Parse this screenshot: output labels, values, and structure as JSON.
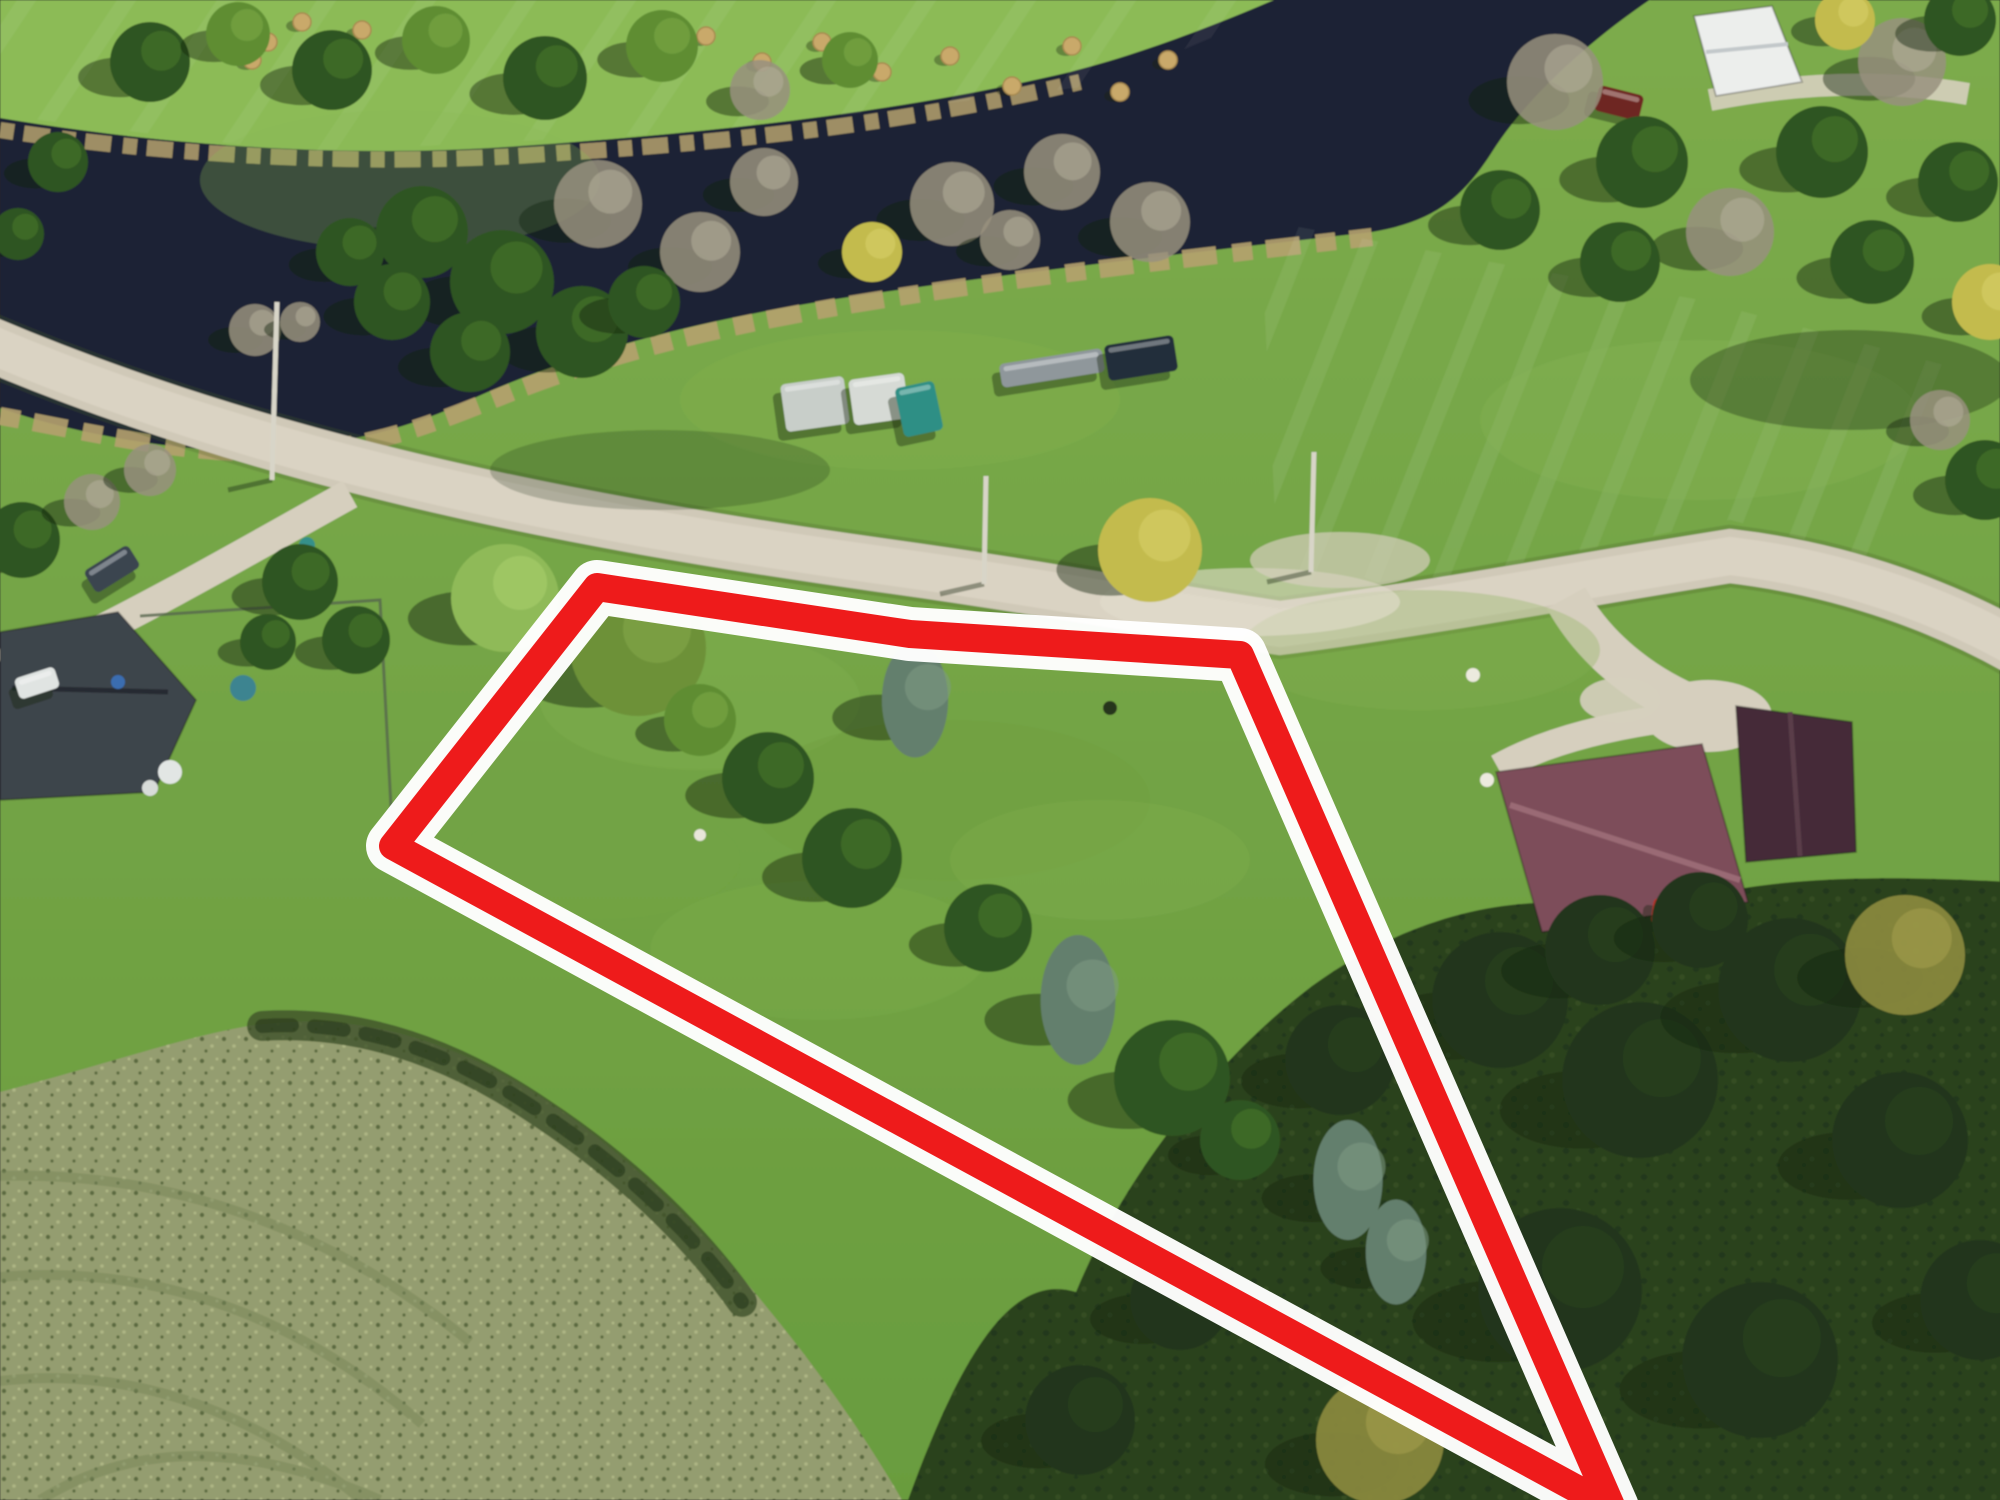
{
  "meta": {
    "domain": "aerial-real-estate-photo",
    "description": "Drone aerial photo of a vacant rural land parcel outlined with a red/white boundary overlay; road to the north, dark river beyond, neighboring houses east and west, tilled field to the southwest.",
    "visible_text": []
  },
  "annotation": {
    "outline_color": "#ee1b1b",
    "halo_color": "#ffffff",
    "outline_width": 28,
    "halo_width": 54
  },
  "scene": {
    "palette": {
      "grass_top": "#7cab4b",
      "grass_bottom": "#699c3e",
      "north_lawn": "#8cbb57",
      "water": "#1c2334",
      "reeds": "#b5a16e",
      "road": "#d0c9b8",
      "road_light": "#e1dbcc",
      "road_shoulder": "rgba(70,90,40,0.25)",
      "driveway": "#d6cfbe",
      "field": "#949d6f",
      "field_dot_dark": "#5b6b41",
      "field_dot_light": "#adb584",
      "scrub": "#3f5229",
      "canopy": "#2c421f",
      "canopy_dot": "#1f3316",
      "fence": "#55654c",
      "peninsula": "#83b351"
    },
    "paths": {
      "north_lawn": "M 0,0 L 1340,0 C 1266,32 1180,60 1078,80 C 900,116 700,140 520,150 C 360,160 180,150 0,122 Z",
      "river": "M 0,118 C 180,148 360,158 520,146 C 720,132 900,112 1070,72 C 1164,48 1256,8 1320,-20 L 1680,-20 C 1600,30 1530,92 1492,152 C 1460,202 1430,222 1372,232 C 1180,254 1000,274 830,300 C 680,324 566,356 470,400 C 386,440 280,458 180,447 C 100,438 40,422 0,408 Z",
      "reed_north": "M 0,130 C 200,160 400,166 560,153 C 760,140 920,120 1080,82",
      "reed_south": "M 0,416 C 80,430 160,450 252,453 C 362,453 422,428 502,396 C 602,356 702,330 842,306 C 1002,279 1182,259 1372,237",
      "peninsula": "M 165,352 C 184,312 240,292 300,300 C 346,308 356,330 330,353 C 290,379 205,383 165,352 Z",
      "field": "M 0,1092 C 120,1060 200,1032 262,1024 C 340,1016 400,1028 470,1058 C 560,1098 640,1168 716,1248 C 790,1330 856,1420 902,1500 L 0,1500 Z",
      "scrub": "M 262,1026 C 360,1020 452,1052 540,1112 C 622,1166 692,1232 742,1302",
      "canopy": "M 908,1500 C 962,1352 1012,1272 1076,1292 C 1122,1180 1212,1062 1312,986 C 1422,906 1542,886 1642,916 C 1722,882 1832,872 2010,882 L 2010,1510 L 908,1510 Z",
      "road": "M -20,340 C 260,460 560,520 880,565 C 1060,590 1170,612 1280,628 C 1420,610 1580,580 1730,556 C 1850,570 1950,610 2020,650",
      "drive_west": "M 350,494 C 256,546 160,602 60,650",
      "drive_east": "M 1566,598 C 1596,652 1648,692 1710,714",
      "drive_east_spur": "M 1706,714 C 1620,722 1548,740 1498,768",
      "drive_ne": "M 1710,100 C 1790,84 1878,78 1968,94",
      "arc1": "M -60,1180 C 140,1158 320,1220 470,1342",
      "arc2": "M -60,1285 C 120,1252 282,1302 422,1424",
      "arc3": "M -60,1392 C 100,1352 242,1402 362,1500",
      "arc4": "M 40,1500 C 150,1432 270,1452 380,1500"
    },
    "parcel": {
      "points": "597,587 910,634 1240,655 1612,1508 393,846"
    },
    "fence_points": "140,616 380,600 393,845",
    "tree_styles": {
      "conifer": {
        "fill": "#2f5520",
        "hl": "#477a2c",
        "op": 1
      },
      "deciduous": {
        "fill": "#5f8d33",
        "hl": "#7cab47",
        "op": 1
      },
      "deciduous-light": {
        "fill": "#8fba58",
        "hl": "#abd06f",
        "op": 1
      },
      "olive": {
        "fill": "#6d9139",
        "hl": "#85a94d",
        "op": 1
      },
      "bare": {
        "fill": "#98917e",
        "hl": "#b5ae9b",
        "op": 0.85
      },
      "spruce": {
        "fill": "#647f6d",
        "hl": "#7e9a84",
        "op": 1
      },
      "yellow": {
        "fill": "#c3bb4e",
        "hl": "#d8d169",
        "op": 1
      },
      "dark": {
        "fill": "#20351a",
        "hl": "#2c4620",
        "op": 1
      },
      "yellow-dark": {
        "fill": "#8d8c3e",
        "hl": "#a5a14d",
        "op": 0.9
      }
    },
    "trees": [
      {
        "x": 150,
        "y": 62,
        "r": 40,
        "type": "conifer"
      },
      {
        "x": 238,
        "y": 34,
        "r": 32,
        "type": "deciduous"
      },
      {
        "x": 332,
        "y": 70,
        "r": 40,
        "type": "conifer"
      },
      {
        "x": 436,
        "y": 40,
        "r": 34,
        "type": "deciduous"
      },
      {
        "x": 545,
        "y": 78,
        "r": 42,
        "type": "conifer"
      },
      {
        "x": 662,
        "y": 46,
        "r": 36,
        "type": "deciduous"
      },
      {
        "x": 58,
        "y": 162,
        "r": 30,
        "type": "conifer"
      },
      {
        "x": 18,
        "y": 234,
        "r": 26,
        "type": "conifer"
      },
      {
        "x": 760,
        "y": 90,
        "r": 30,
        "type": "bare"
      },
      {
        "x": 850,
        "y": 60,
        "r": 28,
        "type": "deciduous"
      },
      {
        "x": 598,
        "y": 204,
        "r": 44,
        "type": "bare"
      },
      {
        "x": 700,
        "y": 252,
        "r": 40,
        "type": "bare"
      },
      {
        "x": 764,
        "y": 182,
        "r": 34,
        "type": "bare"
      },
      {
        "x": 952,
        "y": 204,
        "r": 42,
        "type": "bare"
      },
      {
        "x": 1062,
        "y": 172,
        "r": 38,
        "type": "bare"
      },
      {
        "x": 1150,
        "y": 222,
        "r": 40,
        "type": "bare"
      },
      {
        "x": 872,
        "y": 252,
        "r": 30,
        "type": "yellow"
      },
      {
        "x": 1010,
        "y": 240,
        "r": 30,
        "type": "bare"
      },
      {
        "x": 422,
        "y": 232,
        "r": 46,
        "type": "conifer"
      },
      {
        "x": 502,
        "y": 282,
        "r": 52,
        "type": "conifer"
      },
      {
        "x": 582,
        "y": 332,
        "r": 46,
        "type": "conifer"
      },
      {
        "x": 470,
        "y": 352,
        "r": 40,
        "type": "conifer"
      },
      {
        "x": 392,
        "y": 302,
        "r": 38,
        "type": "conifer"
      },
      {
        "x": 644,
        "y": 302,
        "r": 36,
        "type": "conifer"
      },
      {
        "x": 350,
        "y": 252,
        "r": 34,
        "type": "conifer"
      },
      {
        "x": 255,
        "y": 330,
        "r": 26,
        "type": "bare"
      },
      {
        "x": 300,
        "y": 322,
        "r": 20,
        "type": "bare"
      },
      {
        "x": 1555,
        "y": 82,
        "r": 48,
        "type": "bare"
      },
      {
        "x": 1642,
        "y": 162,
        "r": 46,
        "type": "conifer"
      },
      {
        "x": 1500,
        "y": 210,
        "r": 40,
        "type": "conifer"
      },
      {
        "x": 1730,
        "y": 232,
        "r": 44,
        "type": "bare"
      },
      {
        "x": 1822,
        "y": 152,
        "r": 46,
        "type": "conifer"
      },
      {
        "x": 1902,
        "y": 62,
        "r": 44,
        "type": "bare"
      },
      {
        "x": 1958,
        "y": 182,
        "r": 40,
        "type": "conifer"
      },
      {
        "x": 1872,
        "y": 262,
        "r": 42,
        "type": "conifer"
      },
      {
        "x": 1990,
        "y": 302,
        "r": 38,
        "type": "yellow"
      },
      {
        "x": 1620,
        "y": 262,
        "r": 40,
        "type": "conifer"
      },
      {
        "x": 1960,
        "y": 20,
        "r": 36,
        "type": "conifer"
      },
      {
        "x": 1845,
        "y": 20,
        "r": 30,
        "type": "yellow"
      },
      {
        "x": 1985,
        "y": 480,
        "r": 40,
        "type": "conifer"
      },
      {
        "x": 1940,
        "y": 420,
        "r": 30,
        "type": "bare"
      },
      {
        "x": 505,
        "y": 598,
        "r": 54,
        "type": "deciduous-light"
      },
      {
        "x": 638,
        "y": 648,
        "r": 68,
        "type": "olive"
      },
      {
        "x": 700,
        "y": 720,
        "r": 36,
        "type": "deciduous"
      },
      {
        "x": 768,
        "y": 778,
        "r": 46,
        "type": "conifer"
      },
      {
        "x": 852,
        "y": 858,
        "r": 50,
        "type": "conifer"
      },
      {
        "x": 915,
        "y": 700,
        "r": 46,
        "type": "spruce"
      },
      {
        "x": 988,
        "y": 928,
        "r": 44,
        "type": "conifer"
      },
      {
        "x": 1078,
        "y": 1000,
        "r": 52,
        "type": "spruce"
      },
      {
        "x": 1172,
        "y": 1078,
        "r": 58,
        "type": "conifer"
      },
      {
        "x": 1240,
        "y": 1140,
        "r": 40,
        "type": "conifer"
      },
      {
        "x": 1348,
        "y": 1180,
        "r": 48,
        "type": "spruce"
      },
      {
        "x": 1396,
        "y": 1252,
        "r": 42,
        "type": "spruce"
      },
      {
        "x": 1150,
        "y": 550,
        "r": 52,
        "type": "yellow"
      },
      {
        "x": 22,
        "y": 540,
        "r": 38,
        "type": "conifer"
      },
      {
        "x": 92,
        "y": 502,
        "r": 28,
        "type": "bare"
      },
      {
        "x": 300,
        "y": 582,
        "r": 38,
        "type": "conifer"
      },
      {
        "x": 356,
        "y": 640,
        "r": 34,
        "type": "conifer"
      },
      {
        "x": 268,
        "y": 642,
        "r": 28,
        "type": "conifer"
      },
      {
        "x": 150,
        "y": 470,
        "r": 26,
        "type": "bare"
      },
      {
        "x": 1500,
        "y": 1000,
        "r": 68,
        "type": "dark"
      },
      {
        "x": 1640,
        "y": 1080,
        "r": 78,
        "type": "dark"
      },
      {
        "x": 1790,
        "y": 990,
        "r": 72,
        "type": "dark"
      },
      {
        "x": 1900,
        "y": 1140,
        "r": 68,
        "type": "dark"
      },
      {
        "x": 1560,
        "y": 1290,
        "r": 82,
        "type": "dark"
      },
      {
        "x": 1760,
        "y": 1360,
        "r": 78,
        "type": "dark"
      },
      {
        "x": 1340,
        "y": 1060,
        "r": 55,
        "type": "dark"
      },
      {
        "x": 1905,
        "y": 955,
        "r": 60,
        "type": "yellow-dark"
      },
      {
        "x": 1380,
        "y": 1440,
        "r": 64,
        "type": "yellow-dark"
      },
      {
        "x": 1980,
        "y": 1300,
        "r": 60,
        "type": "dark"
      },
      {
        "x": 1180,
        "y": 1300,
        "r": 50,
        "type": "dark"
      },
      {
        "x": 1080,
        "y": 1420,
        "r": 55,
        "type": "dark"
      },
      {
        "x": 1600,
        "y": 950,
        "r": 55,
        "type": "dark"
      },
      {
        "x": 1700,
        "y": 920,
        "r": 48,
        "type": "dark"
      }
    ],
    "vehicles": [
      {
        "x": 783,
        "y": 380,
        "w": 64,
        "h": 48,
        "rot": -8,
        "fill": "#c8cec9"
      },
      {
        "x": 851,
        "y": 376,
        "w": 56,
        "h": 46,
        "rot": -8,
        "fill": "#d6dad5"
      },
      {
        "x": 899,
        "y": 384,
        "w": 40,
        "h": 50,
        "rot": -12,
        "fill": "#2e8f85"
      },
      {
        "x": 1000,
        "y": 356,
        "w": 104,
        "h": 24,
        "rot": -9,
        "fill": "#8f979b"
      },
      {
        "x": 1106,
        "y": 340,
        "w": 70,
        "h": 36,
        "rot": -9,
        "fill": "#242e3a"
      },
      {
        "x": 1596,
        "y": 90,
        "w": 46,
        "h": 26,
        "rot": 14,
        "fill": "#6e2824"
      },
      {
        "x": 1652,
        "y": 900,
        "w": 36,
        "h": 26,
        "rot": 8,
        "fill": "#b23226"
      },
      {
        "x": 86,
        "y": 556,
        "w": 52,
        "h": 26,
        "rot": -32,
        "fill": "#3a4450"
      },
      {
        "x": 16,
        "y": 672,
        "w": 42,
        "h": 22,
        "rot": -18,
        "fill": "#e0e4e2"
      }
    ],
    "hay_bales": [
      [
        236,
        16
      ],
      [
        268,
        42
      ],
      [
        302,
        22
      ],
      [
        332,
        52
      ],
      [
        362,
        30
      ],
      [
        252,
        60
      ],
      [
        706,
        36
      ],
      [
        762,
        62
      ],
      [
        822,
        42
      ],
      [
        882,
        72
      ],
      [
        950,
        56
      ],
      [
        1012,
        86
      ],
      [
        1072,
        46
      ],
      [
        1120,
        92
      ],
      [
        1168,
        60
      ]
    ],
    "poles": [
      {
        "x1": 277,
        "y1": 302,
        "x2": 272,
        "y2": 480
      },
      {
        "x1": 986,
        "y1": 476,
        "x2": 984,
        "y2": 584
      },
      {
        "x1": 1314,
        "y1": 452,
        "x2": 1311,
        "y2": 572
      }
    ],
    "yard_items": [
      {
        "x": 243,
        "y": 688,
        "r": 13,
        "fill": "#3d8490"
      },
      {
        "x": 118,
        "y": 682,
        "r": 7,
        "fill": "#3a6db0"
      },
      {
        "x": 307,
        "y": 545,
        "r": 8,
        "fill": "#35908a"
      },
      {
        "x": 1473,
        "y": 675,
        "r": 7,
        "fill": "#eceade"
      },
      {
        "x": 1487,
        "y": 780,
        "r": 7,
        "fill": "#eceade"
      },
      {
        "x": 1110,
        "y": 708,
        "r": 7,
        "fill": "#27351f"
      },
      {
        "x": 700,
        "y": 835,
        "r": 6,
        "fill": "#e8e6da"
      },
      {
        "x": 170,
        "y": 772,
        "r": 12,
        "fill": "#e2e6e4"
      },
      {
        "x": 150,
        "y": 788,
        "r": 8,
        "fill": "#d8dcd9"
      }
    ],
    "blotches": [
      {
        "cx": 700,
        "cy": 700,
        "rx": 160,
        "ry": 70,
        "fill": "#86b24f",
        "op": 0.3
      },
      {
        "cx": 950,
        "cy": 800,
        "rx": 200,
        "ry": 80,
        "fill": "#6f9f3f",
        "op": 0.35
      },
      {
        "cx": 820,
        "cy": 950,
        "rx": 170,
        "ry": 70,
        "fill": "#7fae4a",
        "op": 0.3
      },
      {
        "cx": 1100,
        "cy": 860,
        "rx": 150,
        "ry": 60,
        "fill": "#86b24f",
        "op": 0.25
      },
      {
        "cx": 600,
        "cy": 860,
        "rx": 140,
        "ry": 60,
        "fill": "#74a444",
        "op": 0.3
      },
      {
        "cx": 1420,
        "cy": 650,
        "rx": 180,
        "ry": 60,
        "fill": "#83b050",
        "op": 0.3
      },
      {
        "cx": 1700,
        "cy": 420,
        "rx": 220,
        "ry": 80,
        "fill": "#8ab65a",
        "op": 0.25
      },
      {
        "cx": 400,
        "cy": 180,
        "rx": 200,
        "ry": 70,
        "fill": "#8cbb57",
        "op": 0.3
      },
      {
        "cx": 900,
        "cy": 400,
        "rx": 220,
        "ry": 70,
        "fill": "#84b351",
        "op": 0.3
      },
      {
        "cx": 52,
        "cy": 655,
        "rx": 54,
        "ry": 26,
        "fill": "#d6cfbe",
        "op": 1
      },
      {
        "cx": 1708,
        "cy": 716,
        "rx": 64,
        "ry": 36,
        "fill": "#d6cfbe",
        "op": 1
      },
      {
        "cx": 1620,
        "cy": 700,
        "rx": 40,
        "ry": 22,
        "fill": "#d6cfbe",
        "op": 0.9
      },
      {
        "cx": 1250,
        "cy": 602,
        "rx": 150,
        "ry": 34,
        "fill": "#e3ddcd",
        "op": 0.6
      },
      {
        "cx": 1340,
        "cy": 560,
        "rx": 90,
        "ry": 28,
        "fill": "#d6cfbe",
        "op": 0.7
      },
      {
        "cx": 1850,
        "cy": 380,
        "rx": 160,
        "ry": 50,
        "fill": "rgba(25,42,18,0.35)",
        "op": 1
      },
      {
        "cx": 660,
        "cy": 470,
        "rx": 170,
        "ry": 40,
        "fill": "rgba(25,42,18,0.22)",
        "op": 1
      }
    ],
    "buildings": [
      {
        "name": "west-house",
        "points": "0,632 118,612 196,700 154,792 0,800",
        "fill": "#3d444b",
        "ridge": {
          "x1": 12,
          "y1": 688,
          "x2": 168,
          "y2": 692,
          "stroke": "#262c31",
          "w": 5
        }
      },
      {
        "name": "east-house",
        "points": "1496,772 1702,744 1748,902 1542,932",
        "fill": "#7d4e5a",
        "ridge": {
          "x1": 1510,
          "y1": 805,
          "x2": 1740,
          "y2": 880,
          "stroke": "#9a6a74",
          "w": 6
        }
      },
      {
        "name": "east-shed",
        "points": "1736,706 1852,722 1856,852 1746,862",
        "fill": "#442c38",
        "ridge": {
          "x1": 1790,
          "y1": 712,
          "x2": 1800,
          "y2": 856,
          "stroke": "#5a3c49",
          "w": 5
        }
      },
      {
        "name": "white-house",
        "points": "1694,16 1772,6 1802,82 1716,96",
        "fill": "#eceeec",
        "ridge": {
          "x1": 1706,
          "y1": 52,
          "x2": 1788,
          "y2": 44,
          "stroke": "#c2c8ca",
          "w": 4
        }
      }
    ],
    "stripes": [
      {
        "clip": "1260,220 1700,300 2000,380 2000,590 1730,520 1280,612",
        "x0": 1250,
        "y0": 200,
        "count": 12,
        "dx": 68,
        "lenx": -150,
        "leny": 380,
        "op": 0.07
      },
      {
        "clip": "0,0 1300,0 1100,85 700,132 300,152 0,115",
        "x0": 40,
        "y0": -20,
        "count": 14,
        "dx": 100,
        "lenx": -120,
        "leny": 180,
        "op": 0.06
      }
    ]
  }
}
